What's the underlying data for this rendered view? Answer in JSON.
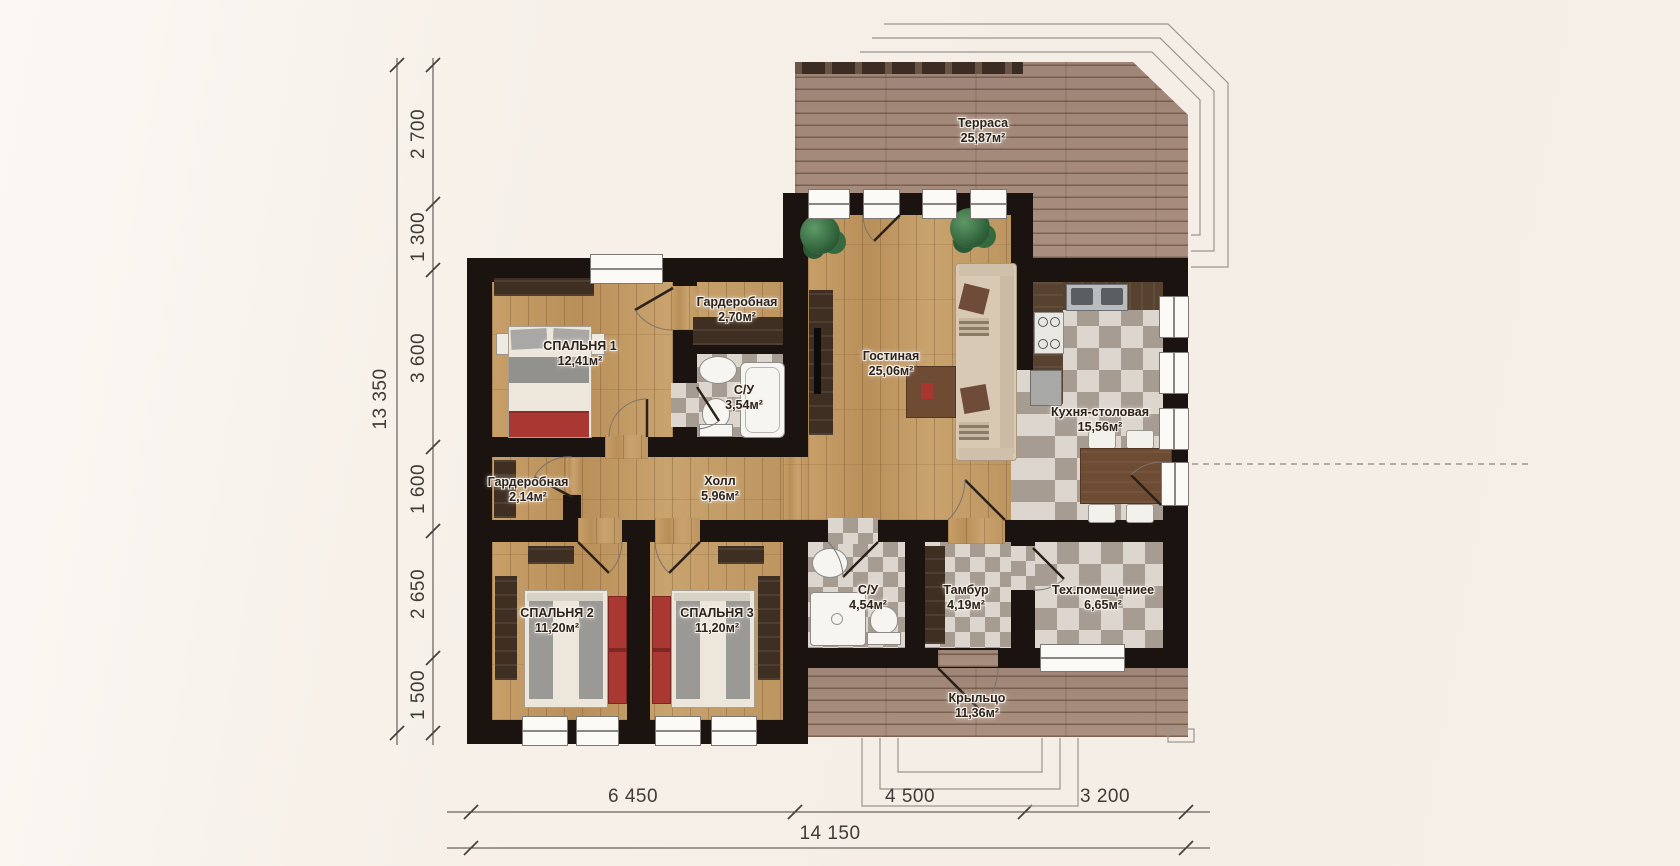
{
  "rooms": {
    "terrace": {
      "name": "Терраса",
      "area": "25,87м²"
    },
    "living": {
      "name": "Гостиная",
      "area": "25,06м²"
    },
    "kitchen": {
      "name": "Кухня-столовая",
      "area": "15,56м²"
    },
    "bedroom1": {
      "name": "СПАЛЬНЯ 1",
      "area": "12,41м²"
    },
    "wardrobe1": {
      "name": "Гардеробная",
      "area": "2,70м²"
    },
    "bath1": {
      "name": "С/У",
      "area": "3,54м²"
    },
    "hall": {
      "name": "Холл",
      "area": "5,96м²"
    },
    "wardrobe2": {
      "name": "Гардеробная",
      "area": "2,14м²"
    },
    "bedroom2": {
      "name": "СПАЛЬНЯ 2",
      "area": "11,20м²"
    },
    "bedroom3": {
      "name": "СПАЛЬНЯ 3",
      "area": "11,20м²"
    },
    "bath2": {
      "name": "С/У",
      "area": "4,54м²"
    },
    "tambour": {
      "name": "Тамбур",
      "area": "4,19м²"
    },
    "tech": {
      "name": "Тех.помещениее",
      "area": "6,65м²"
    },
    "porch": {
      "name": "Крыльцо",
      "area": "11,36м²"
    }
  },
  "dimensions": {
    "total_height": "13 350",
    "height_segments": [
      "2 700",
      "1 300",
      "3 600",
      "1 600",
      "2 650",
      "1 500"
    ],
    "total_width": "14 150",
    "width_segments": [
      "6 450",
      "4 500",
      "3 200"
    ]
  },
  "colors": {
    "background": "#f6f0e9",
    "wall": "#1a1310",
    "wood_floor": "#c29a63",
    "deck": "#a78c7c",
    "tile_light": "#dcd6cf",
    "tile_dark": "#a79c92",
    "accent_red": "#a93732",
    "dimension_line": "#45413d"
  }
}
